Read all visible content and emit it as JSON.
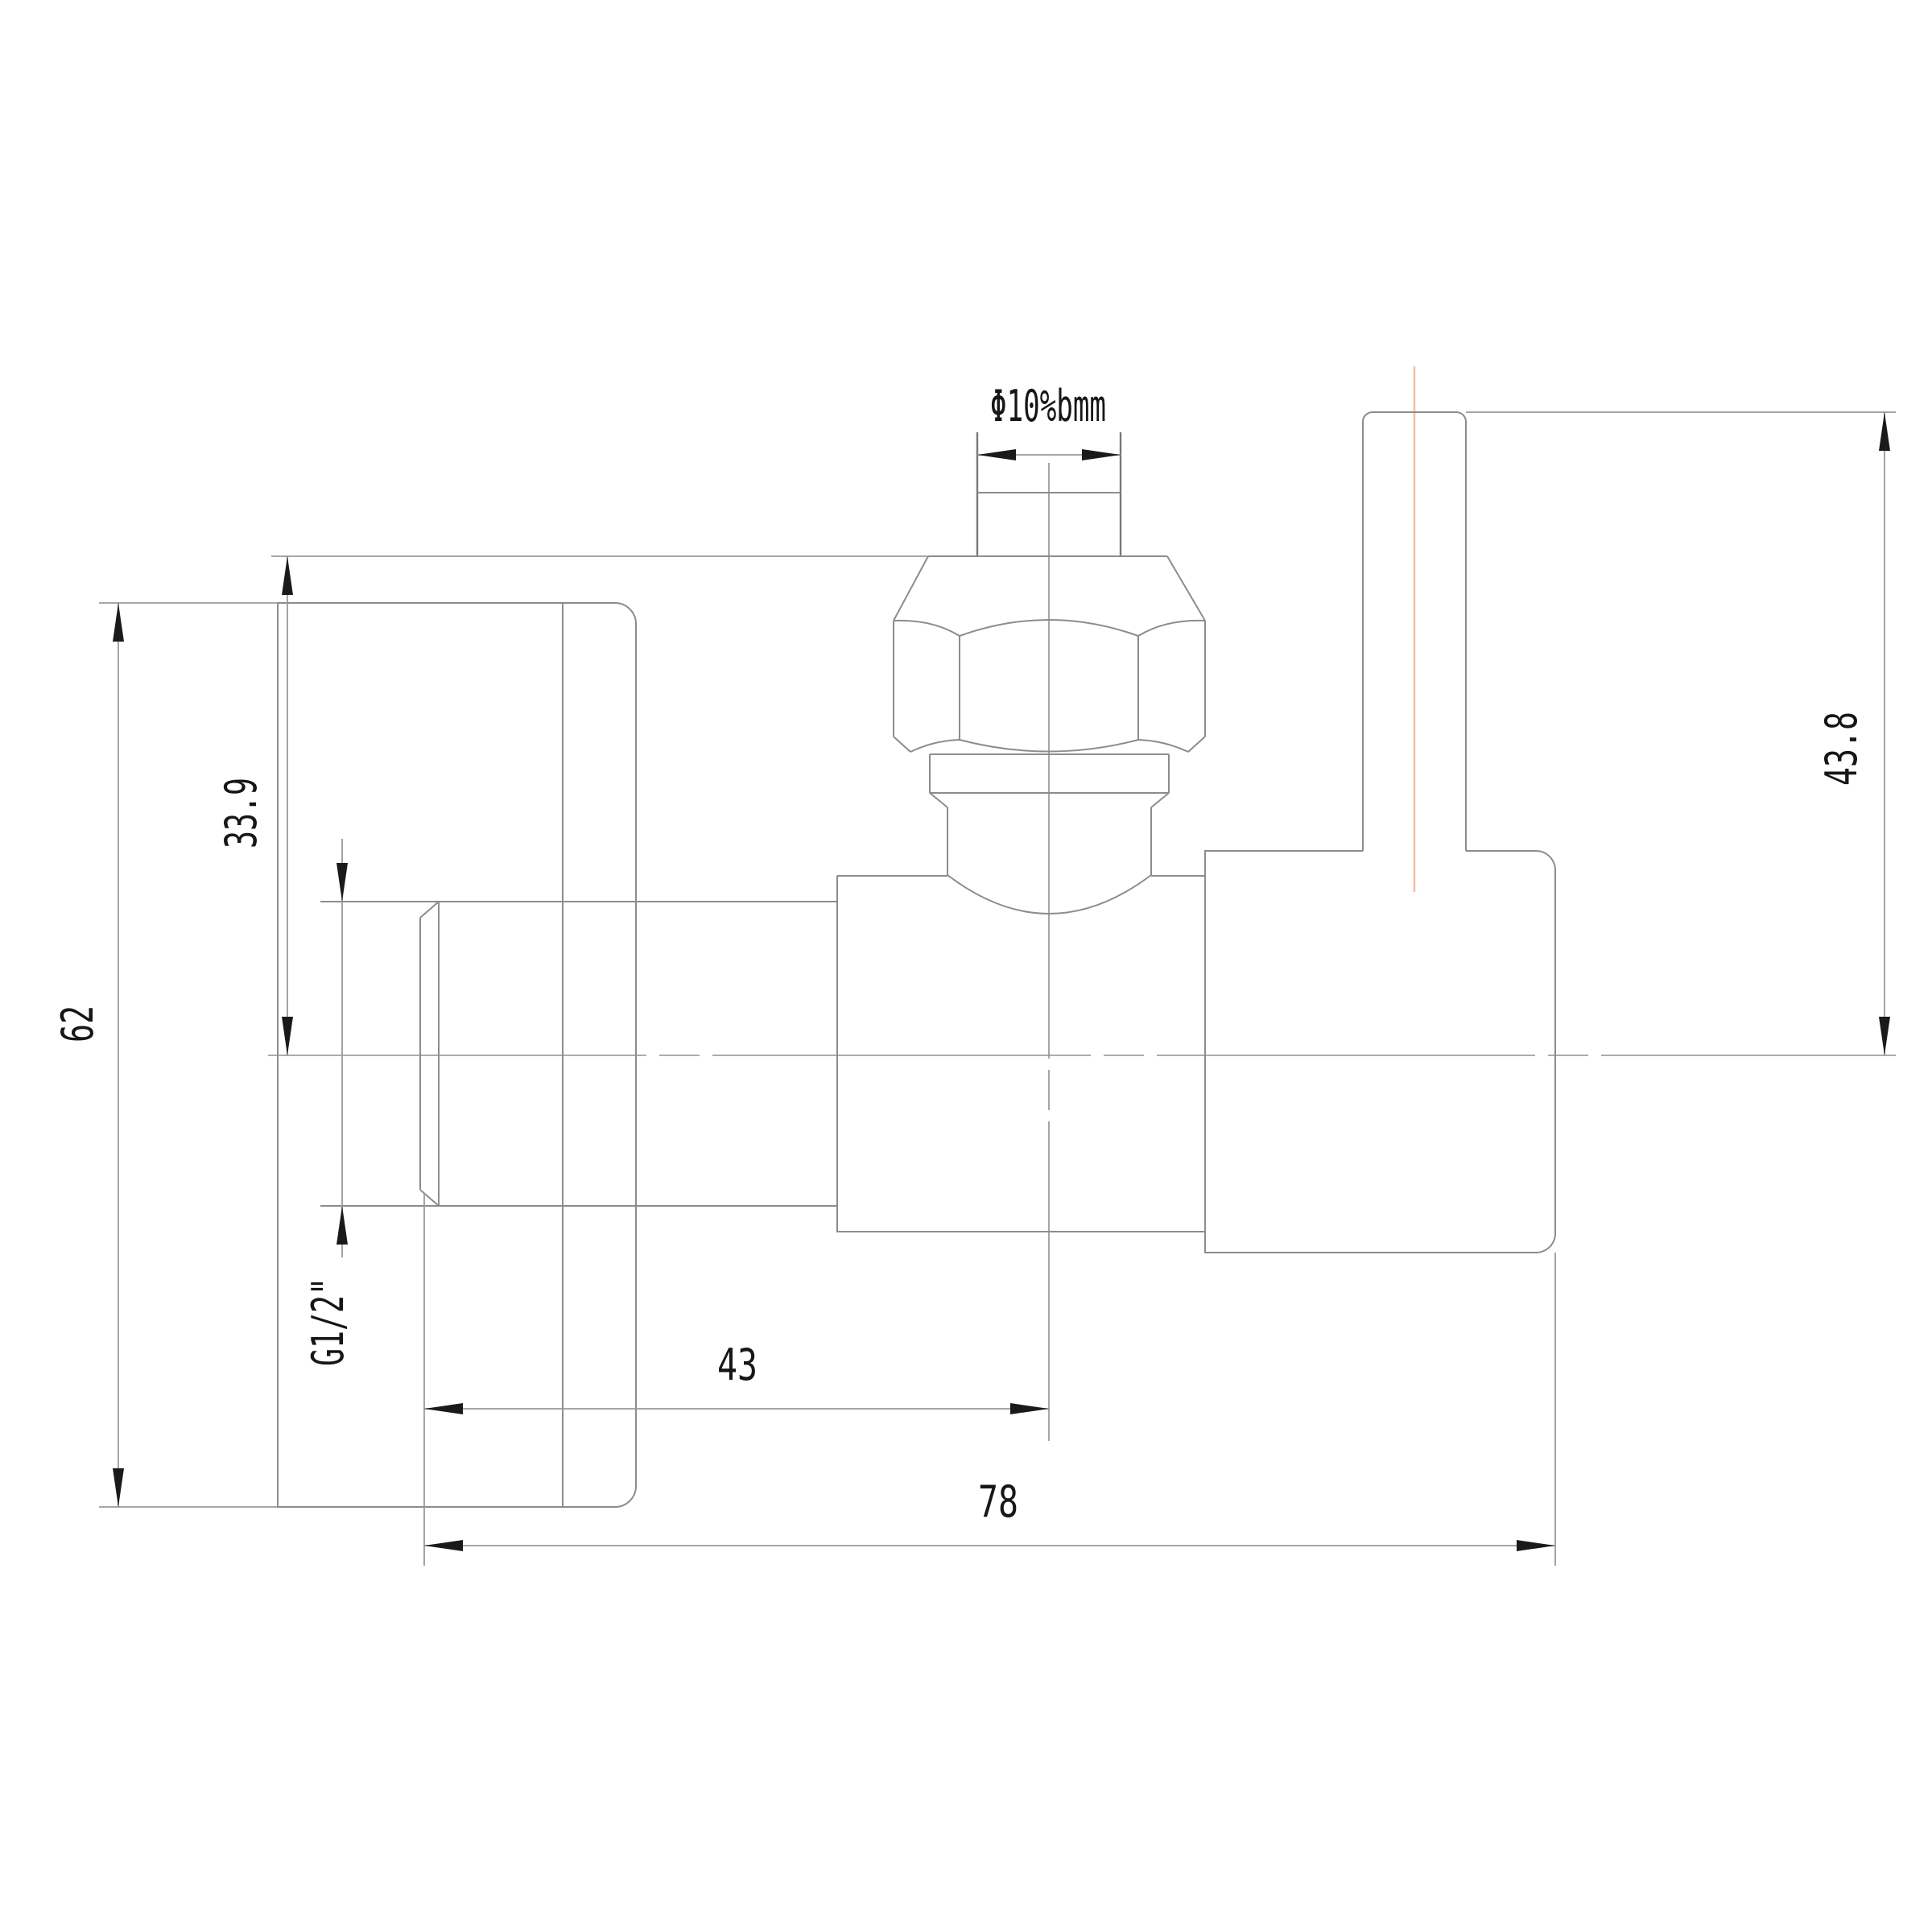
{
  "drawing": {
    "type": "technical-orthographic-view",
    "subject": "angle-valve side elevation with dimensions",
    "dimensions": {
      "top_diameter": {
        "label": "Φ10%bmm",
        "meaning": "outlet pipe diameter"
      },
      "nut_top_to_center": {
        "label": "33.9"
      },
      "plate_height": {
        "label": "62"
      },
      "inlet_thread": {
        "label": "G1/2\""
      },
      "center_to_inlet_end": {
        "label": "43"
      },
      "overall_width": {
        "label": "78"
      },
      "stem_top_to_center": {
        "label": "43.8"
      }
    },
    "colors": {
      "background": "#ffffff",
      "geometry_line": "#8c8c8c",
      "dimension_line": "#9a9a9a",
      "ink": "#161616",
      "stem_centerline_accent": "#f4c0a4"
    }
  }
}
